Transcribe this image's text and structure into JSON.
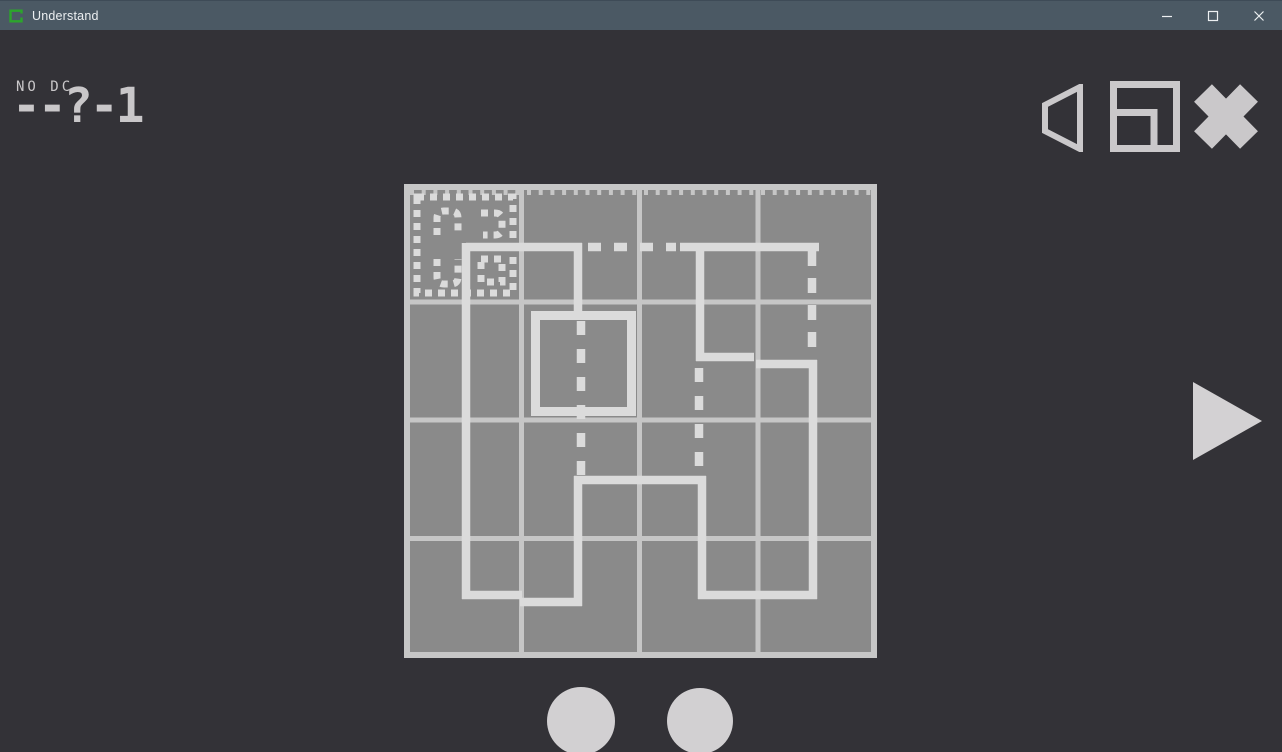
{
  "window": {
    "title": "Understand",
    "controls": [
      "minimize",
      "maximize",
      "close"
    ]
  },
  "hud": {
    "rule_label": "NO DC",
    "level_code": "--?-1"
  },
  "toolbar": {
    "icons": [
      "volume-icon",
      "window-mode-icon",
      "exit-icon"
    ]
  },
  "colors": {
    "background": "#333237",
    "titlebar_bg": "#4b5964",
    "titlebar_text": "#eceff1",
    "logo_green": "#2ca52c",
    "cell_fill": "#8a8a8a",
    "grid_line": "#c6c6c6",
    "draw_line": "#dbdbdb",
    "hud_text": "#c9c7c9",
    "icon_gray": "#cac8ca",
    "circle_fill": "#d2d0d2",
    "triangle_fill": "#d3d1d3"
  },
  "puzzle": {
    "board": {
      "x": 404,
      "y": 154,
      "w": 473,
      "h": 474,
      "cols": 4,
      "rows": 4
    },
    "border_w": 6,
    "line_w": 5,
    "v_lines": [
      117.5,
      235.5,
      354
    ],
    "h_lines": [
      118,
      236,
      354.5
    ],
    "ticks": {
      "d": "M6 8.5 H468",
      "dash": "4 7.7",
      "w": 5
    },
    "solid": [
      {
        "d": "M178 63 H62"
      },
      {
        "d": "M62 59 V415"
      },
      {
        "d": "M58 411 H118"
      },
      {
        "d": "M116 418 H178"
      },
      {
        "d": "M174 292 V422"
      },
      {
        "d": "M170 296 H302"
      },
      {
        "d": "M298 292 V415"
      },
      {
        "d": "M294 411 H413"
      },
      {
        "d": "M409 415 V176"
      },
      {
        "d": "M413 180 H352"
      },
      {
        "d": "M350 173 H292"
      },
      {
        "d": "M296 177 V59"
      },
      {
        "d": "M276 63 H415"
      },
      {
        "d": "M174 59 V133"
      },
      {
        "d": "M131.5 131.5 h96 v96 h-96 Z",
        "w": 9
      }
    ],
    "dashed": [
      {
        "d": "M184 63 H272",
        "dash": "13 13"
      },
      {
        "d": "M408 67 V172",
        "dash": "15 12"
      },
      {
        "d": "M177 137 V292",
        "dash": "14 14"
      },
      {
        "d": "M295 184 V288",
        "dash": "14 14"
      },
      {
        "d": "M13 13 H109 V109 H13 Z",
        "dash": "7 6",
        "w": 7
      },
      {
        "d": "M33 51 V34 Q33 27 40 27 H47 Q54 27 54 34 V51",
        "dash": "7 6",
        "w": 7
      },
      {
        "d": "M77 29 H91 Q98 29 98 36 V44 Q98 51 91 51 H79",
        "dash": "7 6",
        "w": 7
      },
      {
        "d": "M33 75 V93 Q33 100 40 100 H47 Q54 100 54 93 V75",
        "dash": "7 6",
        "w": 7
      },
      {
        "d": "M77 75 H98 V98 H77 Z",
        "dash": "7 6",
        "w": 7
      }
    ]
  },
  "footer": {
    "buttons": [
      "circle",
      "circle"
    ]
  }
}
